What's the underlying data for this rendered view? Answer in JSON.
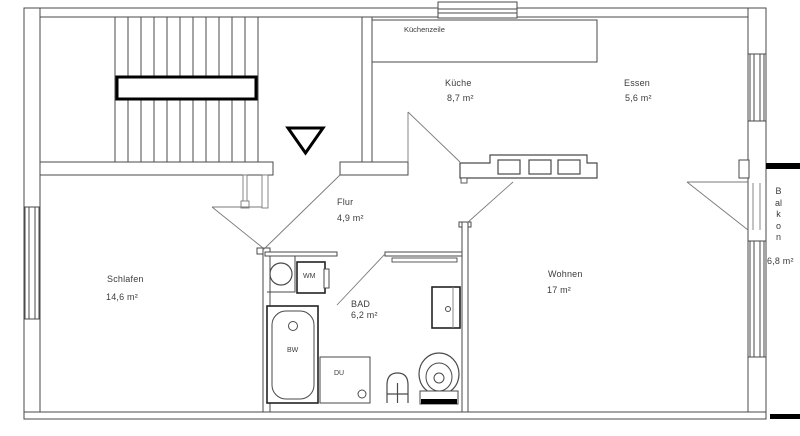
{
  "rooms": {
    "kueche": {
      "name": "Küche",
      "area": "8,7 m²"
    },
    "essen": {
      "name": "Essen",
      "area": "5,6 m²"
    },
    "flur": {
      "name": "Flur",
      "area": "4,9 m²"
    },
    "schlafen": {
      "name": "Schlafen",
      "area": "14,6 m²"
    },
    "bad": {
      "name": "BAD",
      "area": "6,2 m²"
    },
    "wohnen": {
      "name": "Wohnen",
      "area": "17 m²"
    },
    "balkon": {
      "name": "Balkon",
      "area": "6,8 m²"
    }
  },
  "fixtures": {
    "kuechenzeile": {
      "label": "Küchenzeile"
    },
    "washing_machine": {
      "label": "WM"
    },
    "bathtub": {
      "label": "BW"
    },
    "shower": {
      "label": "DU"
    }
  },
  "colors": {
    "line": "#4a4a4a",
    "bold": "#000000",
    "text": "#3c3c3c",
    "background": "#ffffff"
  }
}
